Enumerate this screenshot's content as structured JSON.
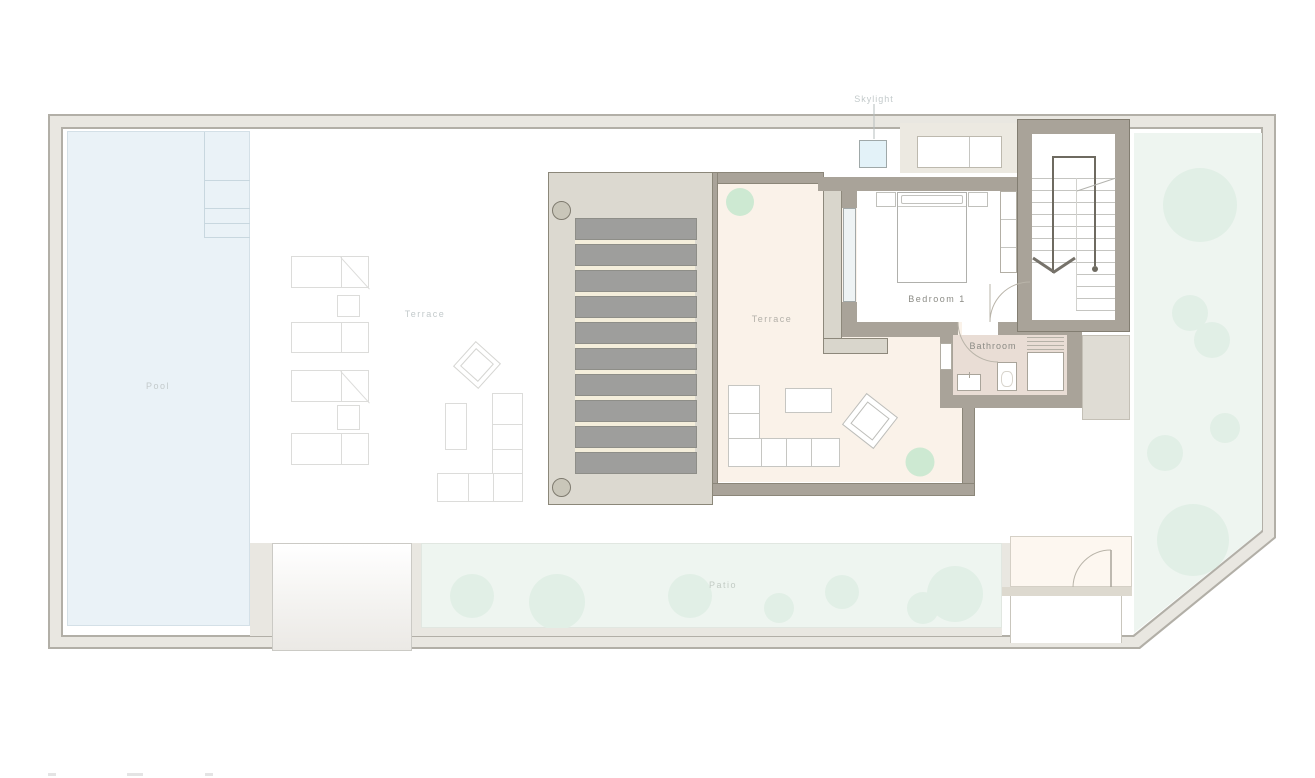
{
  "labels": {
    "skylight": "Skylight",
    "pool": "Pool",
    "deck_terrace": "Terrace",
    "main_terrace": "Terrace",
    "bedroom": "Bedroom 1",
    "bathroom": "Bathroom",
    "patio": "Patio"
  },
  "colors": {
    "wall": "#a9a399",
    "site_band": "#e9e7e1",
    "pool_water": "#eaf2f7",
    "lawn": "#eef5f0",
    "tree": "#e1efe6",
    "terrace_floor": "#faf2e9",
    "bathroom_floor": "#e9ddd5",
    "pergola_frame": "#dcd9d0",
    "pergola_slat": "#9e9e9c",
    "skylight_fill": "#e3f2f8"
  }
}
